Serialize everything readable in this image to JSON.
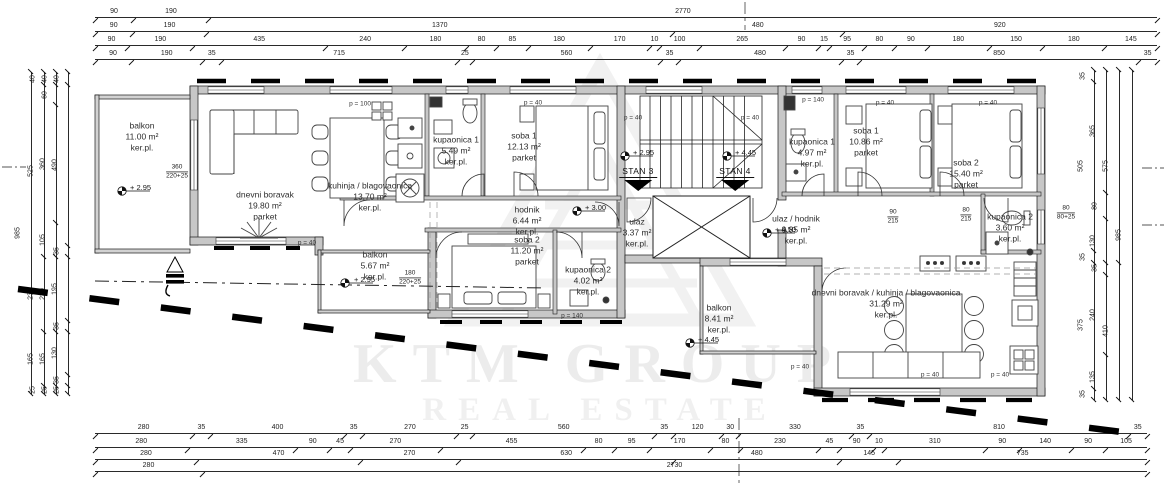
{
  "watermark": {
    "line1": "KTM GROUP",
    "line2": "REAL ESTATE"
  },
  "units": {
    "stan3": {
      "label": "STAN 3",
      "level": "+ 2.95"
    },
    "stan4": {
      "label": "STAN 4",
      "level": "+ 4.45"
    }
  },
  "rooms": {
    "s3_balkon1": {
      "name": "balkon",
      "area": "11.00 m²",
      "floor": "ker.pl."
    },
    "s3_dnevni": {
      "name": "dnevni boravak",
      "area": "19.80 m²",
      "floor": "parket"
    },
    "s3_kuhinja": {
      "name": "kuhinja / blagovaonica",
      "area": "13.70 m²",
      "floor": "ker.pl."
    },
    "s3_kupaonica1": {
      "name": "kupaonica 1",
      "area": "5.49 m²",
      "floor": "ker.pl."
    },
    "s3_soba1": {
      "name": "soba 1",
      "area": "12.13 m²",
      "floor": "parket"
    },
    "s3_hodnik": {
      "name": "hodnik",
      "area": "6.44 m²",
      "floor": "ker.pl."
    },
    "s3_ulaz": {
      "name": "ulaz",
      "area": "3.37 m²",
      "floor": "ker.pl."
    },
    "s3_soba2": {
      "name": "soba 2",
      "area": "11.20 m²",
      "floor": "parket"
    },
    "s3_kupaonica2": {
      "name": "kupaonica 2",
      "area": "4.02 m²",
      "floor": "ker.pl."
    },
    "s3_balkon2": {
      "name": "balkon",
      "area": "5.67 m²",
      "floor": "ker.pl."
    },
    "s4_kupaonica1": {
      "name": "kupaonica 1",
      "area": "4.97 m²",
      "floor": "ker.pl."
    },
    "s4_soba1": {
      "name": "soba 1",
      "area": "10.86 m²",
      "floor": "parket"
    },
    "s4_soba2": {
      "name": "soba 2",
      "area": "15.40 m²",
      "floor": "parket"
    },
    "s4_kupaonica2": {
      "name": "kupaonica 2",
      "area": "3.60 m²",
      "floor": "ker.pl."
    },
    "s4_ulaz": {
      "name": "ulaz / hodnik",
      "area": "9.85 m²",
      "floor": "ker.pl."
    },
    "s4_dnevni": {
      "name": "dnevni boravak / kuhinja / blagovaonica",
      "area": "31.29 m²",
      "floor": "ker.pl."
    },
    "s4_balkon": {
      "name": "balkon",
      "area": "8.41 m²",
      "floor": "ker.pl."
    }
  },
  "levels": {
    "l295a": "+ 2.95",
    "l295b": "+ 2.95",
    "l295c": "+ 2.95",
    "l300": "+ 3.00",
    "l445a": "+ 4.45",
    "l445b": "+ 4.45",
    "l450": "+ 4.50"
  },
  "annotations": {
    "p40": "p = 40",
    "p100": "p = 100",
    "p140": "p = 140"
  },
  "fracs": {
    "f1": {
      "top": "360",
      "bottom": "220+25"
    },
    "f2": {
      "top": "180",
      "bottom": "220+25"
    },
    "f3": {
      "top": "80",
      "bottom": "80+25"
    },
    "f4": {
      "top": "90",
      "bottom": "215"
    },
    "f5": {
      "top": "80",
      "bottom": "215"
    }
  },
  "dimensions": {
    "top": [
      [
        90,
        190,
        2770
      ],
      [
        90,
        190,
        1370,
        480,
        920
      ],
      [
        90,
        190,
        435,
        240,
        180,
        80,
        85,
        180,
        170,
        10,
        100,
        265,
        90,
        15,
        95,
        80,
        90,
        180,
        150,
        180,
        145
      ],
      [
        90,
        190,
        35,
        715,
        25,
        560,
        35,
        480,
        35,
        850,
        35
      ]
    ],
    "bottom": [
      [
        280,
        35,
        400,
        35,
        270,
        25,
        560,
        35,
        120,
        30,
        330,
        35,
        810,
        35
      ],
      [
        280,
        335,
        90,
        45,
        270,
        455,
        80,
        95,
        170,
        80,
        230,
        45,
        90,
        10,
        310,
        90,
        140,
        90,
        105
      ],
      [
        280,
        470,
        270,
        630,
        480,
        145,
        735
      ],
      [
        280,
        2730
      ]
    ],
    "left": [
      [
        985
      ],
      [
        40,
        525,
        230,
        165,
        25
      ],
      [
        40,
        60,
        360,
        105,
        230,
        165,
        25
      ],
      [
        40,
        490,
        35,
        195,
        35,
        130,
        35,
        25
      ]
    ],
    "right": [
      [
        35,
        505,
        35,
        375,
        35
      ],
      [
        365,
        80,
        130,
        35,
        240,
        135
      ],
      [
        575,
        410
      ],
      [
        985
      ]
    ]
  }
}
